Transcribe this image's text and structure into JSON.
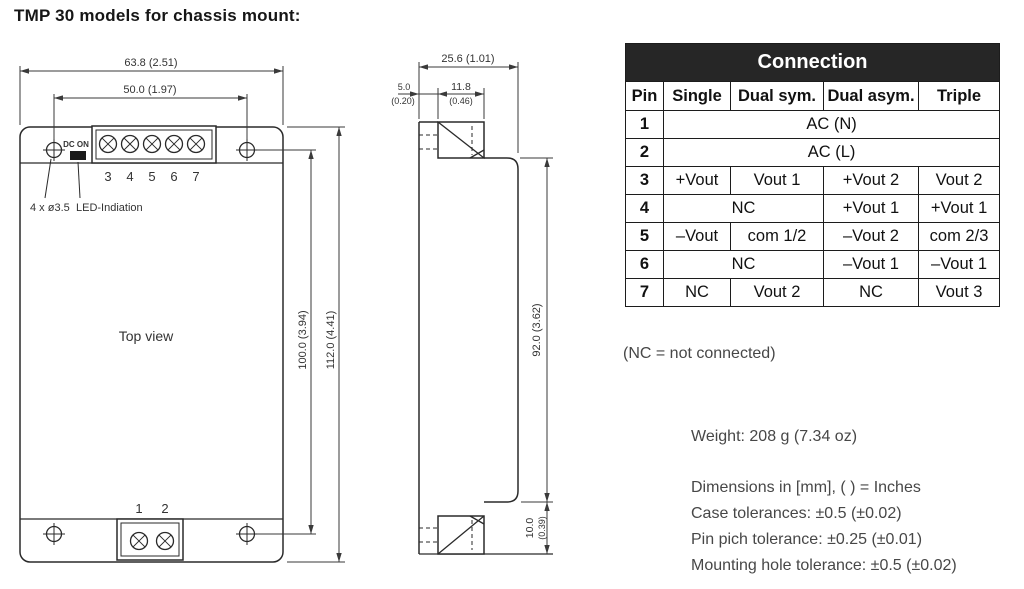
{
  "title": "TMP 30 models for chassis mount:",
  "top_view": {
    "label": "Top view",
    "dim_width_outer": "63.8 (2.51)",
    "dim_width_inner": "50.0 (1.97)",
    "dim_height_inner": "100.0 (3.94)",
    "dim_height_outer": "112.0 (4.41)",
    "hole_note": "4 x ø3.5",
    "led_note": "LED-Indiation",
    "led_label": "DC ON",
    "pin_numbers_top": [
      "3",
      "4",
      "5",
      "6",
      "7"
    ],
    "pin_numbers_bottom": [
      "1",
      "2"
    ]
  },
  "side_view": {
    "dim_depth": "25.6 (1.01)",
    "dim_lip_mm": "5.0",
    "dim_lip_in": "(0.20)",
    "dim_block_mm": "11.8",
    "dim_block_in": "(0.46)",
    "dim_body_height": "92.0 (3.62)",
    "dim_flange_mm": "10.0",
    "dim_flange_in": "(0.39)"
  },
  "connection_table": {
    "title": "Connection",
    "columns": [
      "Pin",
      "Single",
      "Dual sym.",
      "Dual asym.",
      "Triple"
    ],
    "rows": [
      {
        "pin": "1",
        "cells": [
          {
            "text": "AC (N)",
            "span": 4
          }
        ]
      },
      {
        "pin": "2",
        "cells": [
          {
            "text": "AC (L)",
            "span": 4
          }
        ]
      },
      {
        "pin": "3",
        "cells": [
          {
            "text": "+Vout"
          },
          {
            "text": "Vout 1"
          },
          {
            "text": "+Vout 2"
          },
          {
            "text": "Vout 2"
          }
        ]
      },
      {
        "pin": "4",
        "cells": [
          {
            "text": "NC",
            "span": 2
          },
          {
            "text": "+Vout 1"
          },
          {
            "text": "+Vout 1"
          }
        ]
      },
      {
        "pin": "5",
        "cells": [
          {
            "text": "–Vout"
          },
          {
            "text": "com 1/2"
          },
          {
            "text": "–Vout 2"
          },
          {
            "text": "com 2/3"
          }
        ]
      },
      {
        "pin": "6",
        "cells": [
          {
            "text": "NC",
            "span": 2
          },
          {
            "text": "–Vout 1"
          },
          {
            "text": "–Vout 1"
          }
        ]
      },
      {
        "pin": "7",
        "cells": [
          {
            "text": "NC"
          },
          {
            "text": "Vout 2"
          },
          {
            "text": "NC"
          },
          {
            "text": "Vout 3"
          }
        ]
      }
    ]
  },
  "notes": {
    "nc": "(NC = not connected)",
    "weight": "Weight: 208 g (7.34 oz)",
    "tolerances": [
      "Dimensions in [mm], ( ) = Inches",
      "Case tolerances: ±0.5 (±0.02)",
      "Pin pich tolerance: ±0.25 (±0.01)",
      "Mounting hole tolerance: ±0.5 (±0.02)"
    ]
  }
}
